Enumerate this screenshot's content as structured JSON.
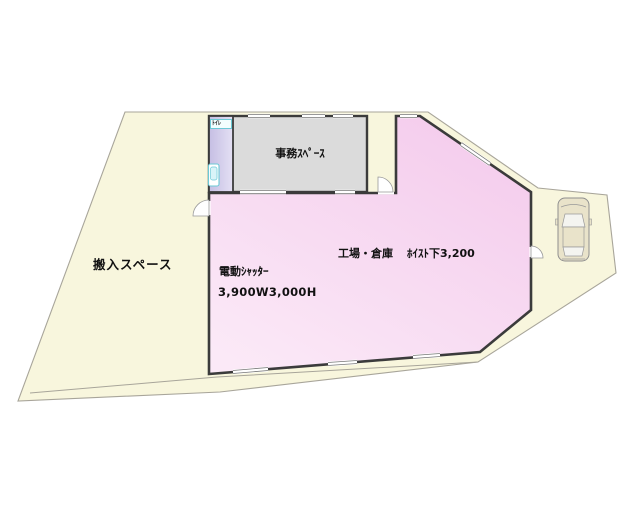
{
  "floorplan": {
    "site": {
      "carry_in_label": "搬入スペース"
    },
    "office": {
      "label": "事務ｽﾍﾟｰｽ"
    },
    "toilet": {
      "label": "ﾄｲﾚ"
    },
    "warehouse": {
      "label": "工場・倉庫",
      "hoist_note": "ﾎｲｽﾄ下3,200",
      "shutter_label": "電動ｼｬｯﾀｰ",
      "shutter_size": "3,900W3,000H"
    },
    "colors": {
      "site_fill": "#F8F6DD",
      "site_boundary": "#A8A59A",
      "warehouse_fill_dark": "#F4CBEC",
      "warehouse_fill_light": "#FBE9F7",
      "office_fill": "#DBDBDB",
      "toilet_fill_dark": "#C5BEE3",
      "toilet_fill_light": "#E4E0F4",
      "wall": "#3B3B3B",
      "fixture_accent": "#6CC9D6",
      "car_body": "#E9E3CA",
      "car_glass": "#F4F4F0"
    }
  }
}
